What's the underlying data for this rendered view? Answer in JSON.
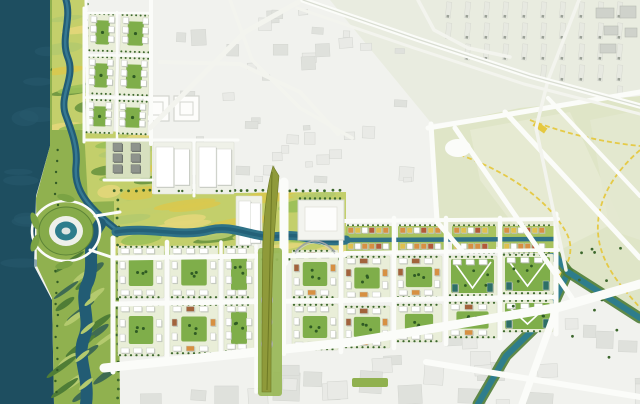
{
  "meta": {
    "description": "Aerial masterplan rendering: dark riverfront water with eye-shaped island, winding greenway corridor, central yellow-green park axis, olive landmark spine, grid of new mixed-use blocks, faded existing city and pale farmland with yellow trails",
    "width": 640,
    "height": 404
  },
  "palette": {
    "water": "#1e4e60",
    "water_texture": "#27596d",
    "river": "#2f7287",
    "river_deep": "#225c74",
    "canal": "#2e7d8c",
    "canal_bank": "#4f7d36",
    "park": "#90b14f",
    "park_light": "#b4ca6e",
    "meadow_yellow": "#d9c94f",
    "meadow_gold": "#e3d77a",
    "wetland_dark": "#4f7d36",
    "wetland_deep": "#3f6b52",
    "tree": "#3c672c",
    "court_green": "#7fae4a",
    "court_dot": "#2f5b24",
    "block_base": "#e9eed8",
    "building_white": "#ffffff",
    "building_shadow": "#b9bdb6",
    "building_dark": "#8e938c",
    "building_brown": "#a2633c",
    "building_orange": "#d79042",
    "building_yellow": "#dfc14d",
    "building_red": "#b35a38",
    "building_teal": "#2e6f66",
    "existing_bg": "#f1f2ee",
    "existing_bg_green": "#e9ece0",
    "existing_building": "#dfe1dc",
    "existing_building_faded": "#e9eae6",
    "fields": "#dfe5c7",
    "fields_light": "#e7ebd3",
    "road": "#fbfcf9",
    "road_minor": "#f3f4ee",
    "path_yellow": "#e5c83f",
    "spine_olive": "#8f9a3a",
    "spine_dark": "#6e7a25",
    "spine_band": "#9ab85a",
    "plaza": "#c2c6bd"
  },
  "water": {
    "shore_polygon": "0,0 52,0 50,146 36,196 34,266 52,300 54,404 0,404",
    "island": {
      "cx": 66,
      "cy": 231,
      "ring_rx": 34,
      "ring_ry": 30,
      "outer_rx": 27,
      "outer_ry": 24,
      "mid_rx": 17,
      "mid_ry": 15,
      "core_rx": 11,
      "core_ry": 9.5
    },
    "bridges": [
      [
        95,
        216,
        120,
        212
      ],
      [
        90,
        250,
        114,
        258
      ]
    ]
  },
  "greenway": {
    "polygon": "50,0 86,0 88,130 104,170 118,192 120,404 54,404 52,298 37,266 36,198 50,146",
    "river_north": "M66,0 C72,20 60,38 68,58 C76,78 58,96 66,116 C72,132 78,148 76,166 C74,186 84,200 96,212 C104,220 112,226 118,231",
    "river_south": "M100,224 C84,246 96,262 88,282 C78,300 92,318 84,338 C76,358 90,376 86,404",
    "river_east": "M116,232 C150,226 180,238 210,230 C235,224 255,240 282,236 C300,233 320,244 346,240",
    "river_east_thin": "M346,240 L558,239"
  },
  "central_park": {
    "polygon": "114,194 346,192 346,256 114,258",
    "west_polygon": "84,128 152,136 152,200 88,202",
    "north_polygon": "52,0 86,0 90,130 52,130",
    "plaza": {
      "x": 298,
      "y": 200,
      "w": 46,
      "h": 40
    },
    "arc": "M295,252 Q315,230 335,252"
  },
  "spine": {
    "band": {
      "x": 258,
      "y": 248,
      "w": 24,
      "h": 148
    },
    "feather": "M273,166 C267,186 264,212 263,242 C262,270 262,310 262,392 L271,392 C271,316 272,268 274,240 C276,210 278,188 279,176 Z",
    "vein": "M272,172 L267,390",
    "orange_path": "M267,258 L267,392",
    "plazas": [
      [
        267,
        300,
        5.5
      ],
      [
        267,
        322,
        5
      ],
      [
        267,
        344,
        5.5
      ]
    ]
  },
  "districts": {
    "residential_north": {
      "blocks": [
        [
          87,
          14,
          28,
          38
        ],
        [
          119,
          14,
          30,
          38
        ],
        [
          87,
          57,
          28,
          38
        ],
        [
          119,
          57,
          30,
          38
        ],
        [
          87,
          100,
          28,
          34
        ],
        [
          119,
          100,
          30,
          34
        ]
      ]
    },
    "north_blocks": [
      {
        "x": 106,
        "y": 138,
        "w": 44,
        "h": 40,
        "v": "dark"
      },
      {
        "x": 153,
        "y": 142,
        "w": 39,
        "h": 52,
        "v": "pale"
      },
      {
        "x": 196,
        "y": 142,
        "w": 38,
        "h": 52,
        "v": "pale"
      },
      {
        "x": 236,
        "y": 196,
        "w": 26,
        "h": 56,
        "v": "pale"
      }
    ],
    "main_grid": [
      [
        118,
        246,
        46,
        52,
        "court"
      ],
      [
        118,
        304,
        46,
        52,
        "court"
      ],
      [
        170,
        246,
        48,
        52,
        "court"
      ],
      [
        170,
        304,
        48,
        50,
        "brown"
      ],
      [
        224,
        246,
        30,
        52,
        "court"
      ],
      [
        224,
        304,
        30,
        48,
        "court"
      ],
      [
        292,
        250,
        46,
        48,
        "brown"
      ],
      [
        292,
        304,
        46,
        46,
        "court"
      ],
      [
        344,
        256,
        46,
        44,
        "brown"
      ],
      [
        344,
        306,
        46,
        42,
        "brown"
      ],
      [
        396,
        256,
        46,
        42,
        "brown"
      ],
      [
        396,
        304,
        46,
        38,
        "court"
      ],
      [
        448,
        256,
        49,
        40,
        "green"
      ],
      [
        448,
        302,
        49,
        36,
        "brown"
      ],
      [
        502,
        254,
        51,
        40,
        "green"
      ],
      [
        502,
        300,
        51,
        32,
        "green"
      ]
    ],
    "riverside_strip": {
      "y": 226,
      "h": 27,
      "clusters": [
        [
          346,
          46
        ],
        [
          398,
          48
        ],
        [
          452,
          44
        ],
        [
          502,
          52
        ]
      ]
    },
    "bottom_green_strip": {
      "x": 352,
      "y": 378,
      "w": 36,
      "h": 9
    }
  },
  "existing_city": {
    "outlined_squares": [
      [
        143,
        96,
        26,
        25
      ],
      [
        174,
        96,
        25,
        25
      ]
    ],
    "far_right_buildings": [
      [
        596,
        8,
        18,
        10
      ],
      [
        620,
        6,
        16,
        12
      ],
      [
        604,
        26,
        14,
        9
      ],
      [
        625,
        28,
        12,
        9
      ],
      [
        600,
        44,
        16,
        9
      ]
    ],
    "mid_right_buildings": [
      [
        570,
        242,
        16,
        12
      ],
      [
        592,
        238,
        20,
        10
      ],
      [
        612,
        250,
        14,
        14
      ],
      [
        574,
        262,
        12,
        10
      ],
      [
        596,
        266,
        18,
        9
      ]
    ],
    "scatter_zones": [
      {
        "id": "top",
        "x": 150,
        "y": 4,
        "w": 278,
        "h": 174,
        "count": 42,
        "smin": 6,
        "smax": 15
      },
      {
        "id": "bottom",
        "x": 118,
        "y": 300,
        "w": 522,
        "h": 100,
        "count": 30,
        "smin": 12,
        "smax": 28
      }
    ],
    "industrial": {
      "x0": 446,
      "x1": 634,
      "col_step": 19,
      "y0": 2,
      "y1": 110,
      "row_step": 21
    }
  },
  "fields": {
    "polygon": "432,126 520,108 640,96 640,316 610,300 568,272 544,240 464,252 440,224",
    "parcels": [
      "470,130 570,112 620,220 540,260 480,180",
      "590,120 640,110 640,240 610,230"
    ],
    "junction": {
      "cx": 458,
      "cy": 148,
      "rx": 13,
      "ry": 9
    },
    "yellow_paths": [
      "M452,152 C500,168 545,195 566,232 C577,252 566,272 550,284",
      "M640,150 C600,185 588,225 606,262 C616,283 634,300 640,308",
      "M530,120 C560,132 600,142 640,146"
    ],
    "yellow_marker": {
      "x": 533,
      "y": 124,
      "w": 14,
      "h": 6,
      "rot": 35
    }
  },
  "infrastructure": {
    "canal_main": "M542,238 L568,272 L549,314 L506,356 L478,404",
    "canal_branch": "M568,272 L612,300 L640,318",
    "roads": [
      {
        "w": 5,
        "pts": [
          [
            113,
            238
          ],
          [
            113,
            372
          ]
        ]
      },
      {
        "w": 4.5,
        "pts": [
          [
            167,
            242
          ],
          [
            167,
            362
          ]
        ]
      },
      {
        "w": 3.5,
        "pts": [
          [
            221,
            242
          ],
          [
            221,
            358
          ]
        ]
      },
      {
        "w": 3.5,
        "pts": [
          [
            256,
            246
          ],
          [
            256,
            392
          ]
        ]
      },
      {
        "w": 4,
        "pts": [
          [
            284,
            244
          ],
          [
            284,
            354
          ]
        ]
      },
      {
        "w": 4.5,
        "pts": [
          [
            341,
            218
          ],
          [
            341,
            352
          ]
        ]
      },
      {
        "w": 4.5,
        "pts": [
          [
            394,
            218
          ],
          [
            394,
            348
          ]
        ]
      },
      {
        "w": 4.5,
        "pts": [
          [
            446,
            218
          ],
          [
            446,
            344
          ]
        ]
      },
      {
        "w": 4.5,
        "pts": [
          [
            500,
            218
          ],
          [
            500,
            338
          ]
        ]
      },
      {
        "w": 5,
        "pts": [
          [
            556,
            214
          ],
          [
            556,
            334
          ]
        ]
      },
      {
        "w": 5,
        "pts": [
          [
            113,
            258
          ],
          [
            345,
            255
          ]
        ]
      },
      {
        "w": 4,
        "pts": [
          [
            345,
            221
          ],
          [
            558,
            219
          ]
        ]
      },
      {
        "w": 4,
        "pts": [
          [
            345,
            253
          ],
          [
            558,
            250
          ]
        ]
      },
      {
        "w": 5,
        "pts": [
          [
            113,
            304
          ],
          [
            556,
            297
          ]
        ]
      },
      {
        "w": 9,
        "pts": [
          [
            104,
            368
          ],
          [
            352,
            342
          ],
          [
            560,
            307
          ],
          [
            640,
            284
          ]
        ]
      },
      {
        "w": 7,
        "pts": [
          [
            557,
            307
          ],
          [
            522,
            404
          ]
        ]
      },
      {
        "w": 6,
        "pts": [
          [
            426,
            362
          ],
          [
            640,
            397
          ]
        ]
      },
      {
        "w": 9,
        "pts": [
          [
            284,
            182
          ],
          [
            284,
            262
          ]
        ]
      },
      {
        "w": 3,
        "pts": [
          [
            84,
            8
          ],
          [
            84,
            142
          ]
        ]
      },
      {
        "w": 2.5,
        "pts": [
          [
            117,
            12
          ],
          [
            117,
            140
          ]
        ]
      },
      {
        "w": 4,
        "pts": [
          [
            151,
            0
          ],
          [
            151,
            144
          ]
        ]
      },
      {
        "w": 2.5,
        "pts": [
          [
            84,
            13
          ],
          [
            151,
            13
          ]
        ]
      },
      {
        "w": 2.5,
        "pts": [
          [
            84,
            55.5
          ],
          [
            151,
            55.5
          ]
        ]
      },
      {
        "w": 2.5,
        "pts": [
          [
            84,
            97.5
          ],
          [
            151,
            97.5
          ]
        ]
      },
      {
        "w": 3,
        "pts": [
          [
            84,
            140
          ],
          [
            151,
            140
          ]
        ]
      },
      {
        "w": 3,
        "pts": [
          [
            150,
            140
          ],
          [
            238,
            140
          ]
        ]
      },
      {
        "w": 3,
        "pts": [
          [
            194,
            142
          ],
          [
            194,
            196
          ]
        ]
      },
      {
        "w": 3,
        "pts": [
          [
            104,
            180
          ],
          [
            152,
            180
          ]
        ]
      },
      {
        "k": "minor",
        "w": 5,
        "pts": [
          [
            150,
            128
          ],
          [
            245,
            32
          ],
          [
            302,
            0
          ]
        ]
      },
      {
        "k": "minor",
        "w": 4,
        "pts": [
          [
            160,
            62
          ],
          [
            240,
            64
          ],
          [
            300,
            92
          ],
          [
            338,
            134
          ]
        ]
      },
      {
        "k": "minor",
        "w": 3.5,
        "pts": [
          [
            230,
            0
          ],
          [
            252,
            60
          ],
          [
            300,
            108
          ],
          [
            352,
            138
          ]
        ]
      },
      {
        "w": 5,
        "pts": [
          [
            431,
            124
          ],
          [
            437,
            222
          ],
          [
            463,
            252
          ]
        ]
      },
      {
        "w": 5,
        "pts": [
          [
            455,
            128
          ],
          [
            572,
            298
          ]
        ]
      },
      {
        "w": 5,
        "pts": [
          [
            505,
            112
          ],
          [
            640,
            258
          ]
        ]
      },
      {
        "w": 4,
        "pts": [
          [
            548,
            98
          ],
          [
            640,
            196
          ]
        ]
      },
      {
        "w": 5,
        "pts": [
          [
            428,
            128
          ],
          [
            640,
            92
          ]
        ]
      },
      {
        "k": "minor",
        "w": 3.5,
        "pts": [
          [
            579,
            0
          ],
          [
            548,
            80
          ],
          [
            536,
            128
          ],
          [
            549,
            190
          ],
          [
            566,
            270
          ]
        ]
      },
      {
        "k": "hwy",
        "w": 5.5,
        "pts": [
          [
            303,
            0
          ],
          [
            420,
            40
          ],
          [
            530,
            76
          ],
          [
            640,
            106
          ]
        ]
      },
      {
        "k": "minor",
        "w": 3,
        "pts": [
          [
            297,
            8
          ],
          [
            414,
            48
          ],
          [
            524,
            84
          ],
          [
            640,
            114
          ]
        ]
      },
      {
        "k": "minor",
        "w": 3.5,
        "pts": [
          [
            418,
            0
          ],
          [
            434,
            30
          ],
          [
            468,
            48
          ],
          [
            510,
            57
          ]
        ]
      },
      {
        "w": 3,
        "pts": [
          [
            86,
            0
          ],
          [
            88,
            130
          ]
        ]
      }
    ]
  }
}
